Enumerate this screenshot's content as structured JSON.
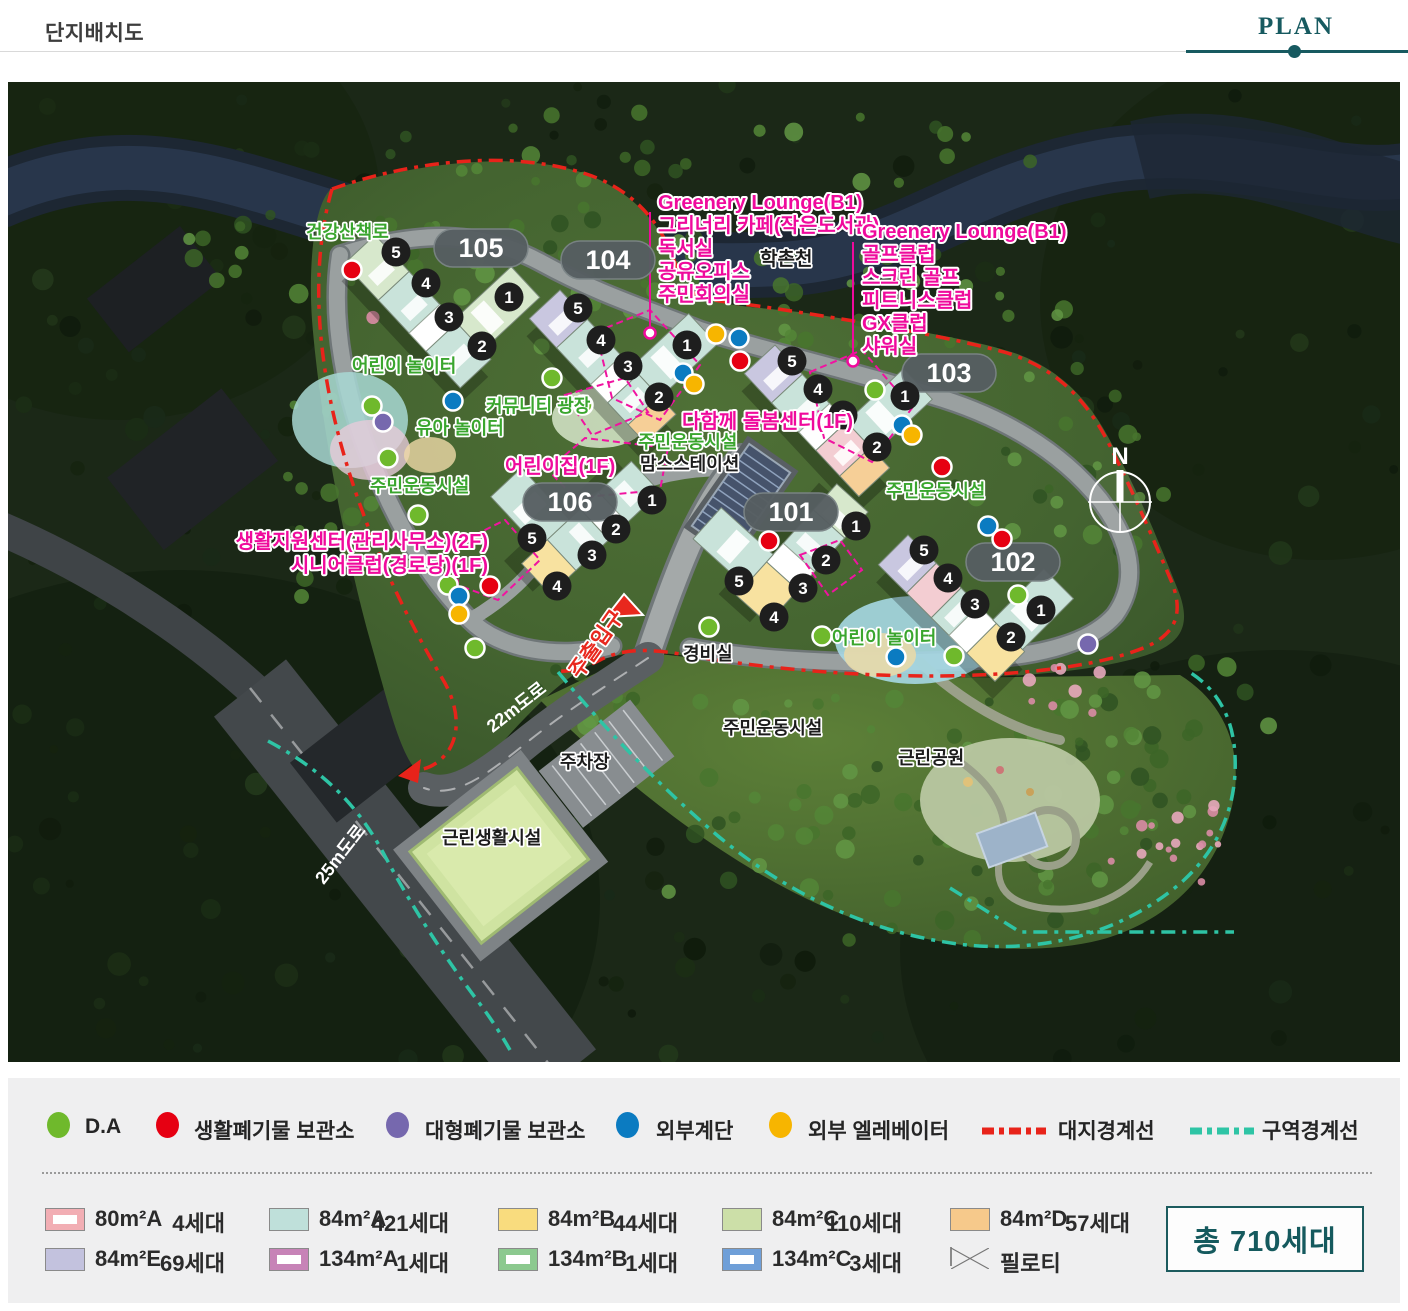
{
  "header": {
    "title": "단지배치도",
    "tab": "PLAN"
  },
  "map": {
    "badges": {
      "b101": "101",
      "b102": "102",
      "b103": "103",
      "b104": "104",
      "b105": "105",
      "b106": "106"
    },
    "circle_numbers": {
      "n1": "1",
      "n2": "2",
      "n3": "3",
      "n4": "4",
      "n5": "5"
    },
    "annotation_left": {
      "lines": [
        "Greenery Lounge(B1)",
        "그리너리 카페(작은도서관)",
        "독서실",
        "공유오피스",
        "주민회의실"
      ]
    },
    "annotation_right": {
      "lines": [
        "Greenery Lounge(B1)",
        "골프클럽",
        "스크린 골프",
        "피트니스클럽",
        "GX클럽",
        "샤워실"
      ]
    },
    "labels": {
      "trail": "건강산책로",
      "river": "학촌천",
      "kids_play_1": "어린이 놀이터",
      "community_plaza": "커뮤니티 광장",
      "toddler_play": "유아 놀이터",
      "sports_1": "주민운동시설",
      "sports_2": "주민운동시설",
      "sports_3": "주민운동시설",
      "sports_4": "주민운동시설",
      "daycare": "어린이집(1F)",
      "support_center": "생활지원센터(관리사무소)(2F)",
      "senior_club": "시니어클럽(경로당)(1F)",
      "care_center": "다함께 돌봄센터(1F)",
      "moms_station": "맘스스테이션",
      "guard_post": "경비실",
      "kids_play_2": "어린이 놀이터",
      "parking": "주차장",
      "neighborhood_park": "근린공원",
      "neighborhood_facility": "근린생활시설",
      "road_22m": "22m도로",
      "road_25m": "25m도로",
      "main_entrance": "주출입구",
      "compass_n": "N"
    },
    "colors": {
      "annotation_pink": "#ef0a9c",
      "label_green": "#3aa62e",
      "site_boundary_red": "#e8231a",
      "district_boundary_teal": "#2ec4a5"
    }
  },
  "legend": {
    "items": [
      {
        "label": "D.A",
        "color": "#6fb92c",
        "type": "dot"
      },
      {
        "label": "생활폐기물 보관소",
        "color": "#e60012",
        "type": "dot"
      },
      {
        "label": "대형폐기물 보관소",
        "color": "#7668ae",
        "type": "dot"
      },
      {
        "label": "외부계단",
        "color": "#0b7bc1",
        "type": "dot"
      },
      {
        "label": "외부 엘레베이터",
        "color": "#f7b500",
        "type": "dot"
      },
      {
        "label": "대지경계선",
        "color": "#e8231a",
        "type": "dash"
      },
      {
        "label": "구역경계선",
        "color": "#2ec4a5",
        "type": "dash"
      }
    ]
  },
  "units": {
    "items": [
      {
        "name": "80m²A",
        "count": "4세대",
        "color": "#f2aeb4",
        "style": "frame"
      },
      {
        "name": "84m²A",
        "count": "421세대",
        "color": "#bfe0da",
        "style": "solid"
      },
      {
        "name": "84m²B",
        "count": "44세대",
        "color": "#f9dc7e",
        "style": "solid"
      },
      {
        "name": "84m²C",
        "count": "110세대",
        "color": "#ccdfa8",
        "style": "solid"
      },
      {
        "name": "84m²D",
        "count": "57세대",
        "color": "#f6c98b",
        "style": "solid"
      },
      {
        "name": "84m²E",
        "count": "69세대",
        "color": "#c3c2de",
        "style": "solid"
      },
      {
        "name": "134m²A",
        "count": "1세대",
        "color": "#c783b7",
        "style": "frame"
      },
      {
        "name": "134m²B",
        "count": "1세대",
        "color": "#8cc98f",
        "style": "frame"
      },
      {
        "name": "134m²C",
        "count": "3세대",
        "color": "#6f9fd8",
        "style": "frame"
      },
      {
        "name": "필로티",
        "count": "",
        "color": "#ffffff",
        "style": "cross"
      }
    ],
    "total": "총 710세대"
  }
}
